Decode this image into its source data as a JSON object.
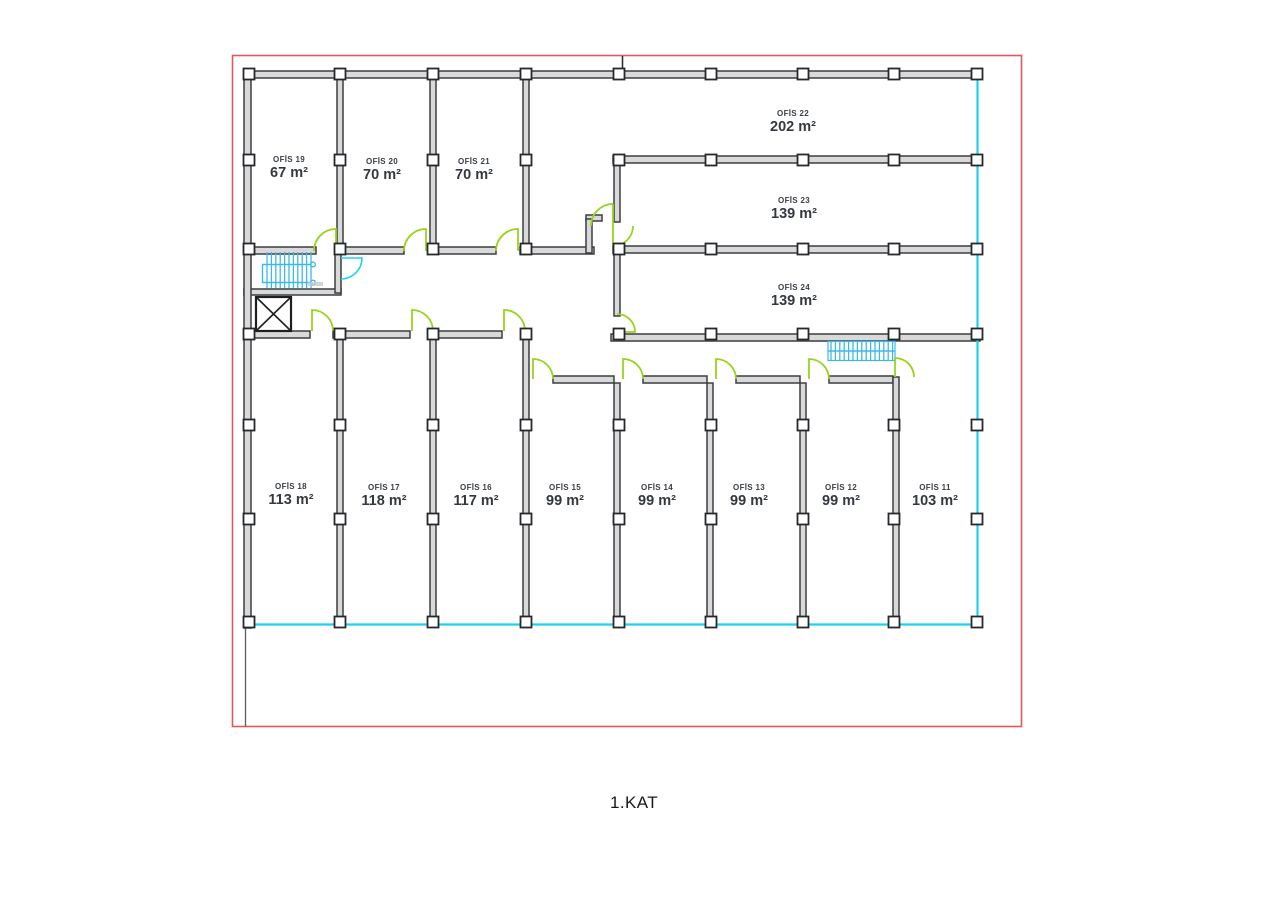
{
  "title": "1.KAT",
  "rooms": [
    {
      "name": "OFİS 19",
      "area": "67 m²"
    },
    {
      "name": "OFİS 20",
      "area": "70 m²"
    },
    {
      "name": "OFİS 21",
      "area": "70 m²"
    },
    {
      "name": "OFİS 22",
      "area": "202 m²"
    },
    {
      "name": "OFİS 23",
      "area": "139 m²"
    },
    {
      "name": "OFİS 24",
      "area": "139 m²"
    },
    {
      "name": "OFİS 18",
      "area": "113 m²"
    },
    {
      "name": "OFİS 17",
      "area": "118 m²"
    },
    {
      "name": "OFİS 16",
      "area": "117 m²"
    },
    {
      "name": "OFİS 15",
      "area": "99 m²"
    },
    {
      "name": "OFİS 14",
      "area": "99 m²"
    },
    {
      "name": "OFİS 13",
      "area": "99 m²"
    },
    {
      "name": "OFİS 12",
      "area": "99 m²"
    },
    {
      "name": "OFİS 11",
      "area": "103 m²"
    }
  ],
  "features": [
    {
      "icon": "stairs-icon",
      "location": "upper-left-core"
    },
    {
      "icon": "stairs-icon",
      "location": "right-corridor"
    },
    {
      "icon": "elevator-icon",
      "location": "left-core"
    },
    {
      "icon": "door-swing-icon",
      "count": 14
    }
  ],
  "colors": {
    "boundary_red": "#e0585a",
    "curtain_wall_cyan": "#19d3f0",
    "stair_blue": "#3cb9ea",
    "door_green": "#98d31e",
    "wall_gray": "#3b3d41"
  }
}
